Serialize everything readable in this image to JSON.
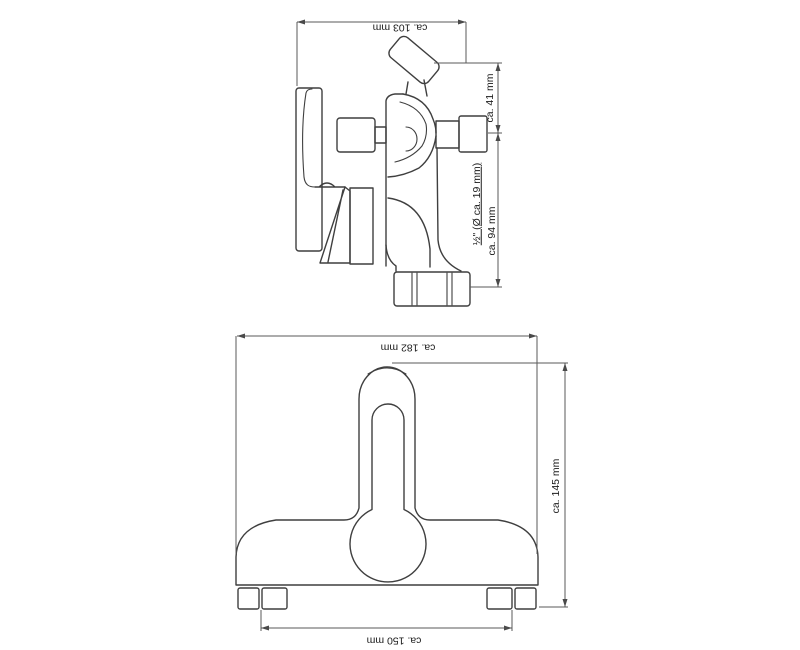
{
  "drawing": {
    "type": "technical-dimension-drawing",
    "subject": "wall-mounted bathtub mixer tap",
    "background_color": "#ffffff",
    "object_line_color": "#3f3f3f",
    "dimension_line_color": "#5a5a5a",
    "text_color": "#1a1a1a",
    "views": [
      {
        "id": "side-view",
        "dimensions": [
          {
            "label": "ca. 103 mm",
            "axis": "horizontal"
          },
          {
            "label": "ca. 41 mm",
            "axis": "vertical"
          },
          {
            "label": "½\" (Ø ca. 19 mm)",
            "axis": "vertical",
            "underlined": true
          },
          {
            "label": "ca. 94 mm",
            "axis": "vertical"
          }
        ]
      },
      {
        "id": "front-view",
        "dimensions": [
          {
            "label": "ca. 182 mm",
            "axis": "horizontal"
          },
          {
            "label": "ca. 145 mm",
            "axis": "vertical"
          },
          {
            "label": "ca. 150 mm",
            "axis": "horizontal"
          }
        ]
      }
    ]
  },
  "labels": {
    "side_width": "ca. 103 mm",
    "side_outlet_offset": "ca. 41 mm",
    "side_thread": "½\" (Ø ca. 19 mm)",
    "side_height": "ca. 94 mm",
    "front_width": "ca. 182 mm",
    "front_height": "ca. 145 mm",
    "front_hole_distance": "ca. 150 mm"
  }
}
